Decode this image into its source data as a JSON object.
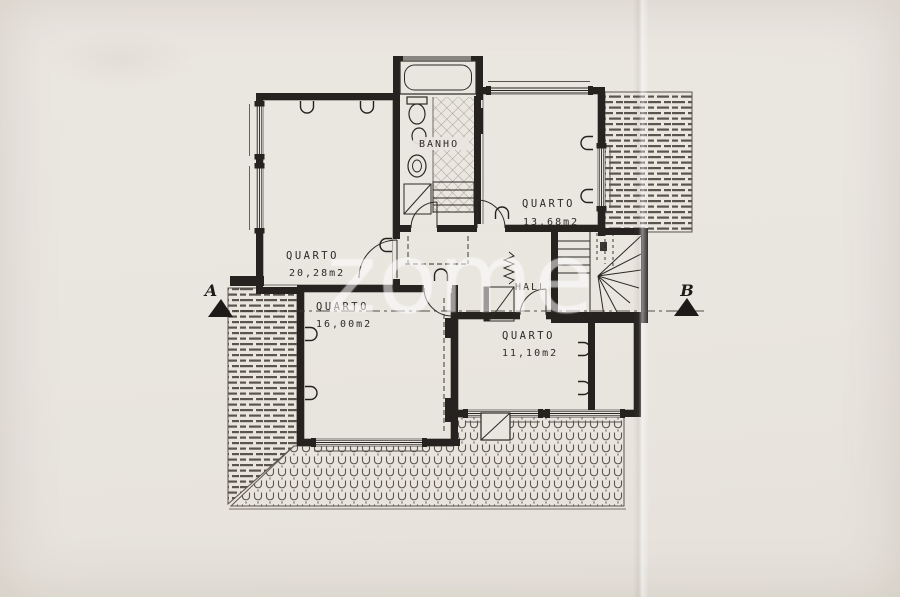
{
  "document": {
    "type": "scanned floor plan drawing",
    "language": "Portuguese"
  },
  "colors": {
    "paper": "#e9e5df",
    "ink": "#262220",
    "hatch_ink": "#5b554e",
    "watermark": "rgba(255,255,255,0.55)"
  },
  "watermark": {
    "text": "zome"
  },
  "rooms": {
    "left": {
      "name": "QUARTO",
      "area": "20,28m2"
    },
    "right": {
      "name": "QUARTO",
      "area": "13,68m2"
    },
    "middle": {
      "name": "QUARTO",
      "area": "16,00m2"
    },
    "lower": {
      "name": "QUARTO",
      "area": "11,10m2"
    },
    "bath": {
      "name": "BANHO"
    },
    "hall": {
      "name": "HALL"
    }
  },
  "section": {
    "left_marker": "A",
    "right_marker": "B"
  }
}
